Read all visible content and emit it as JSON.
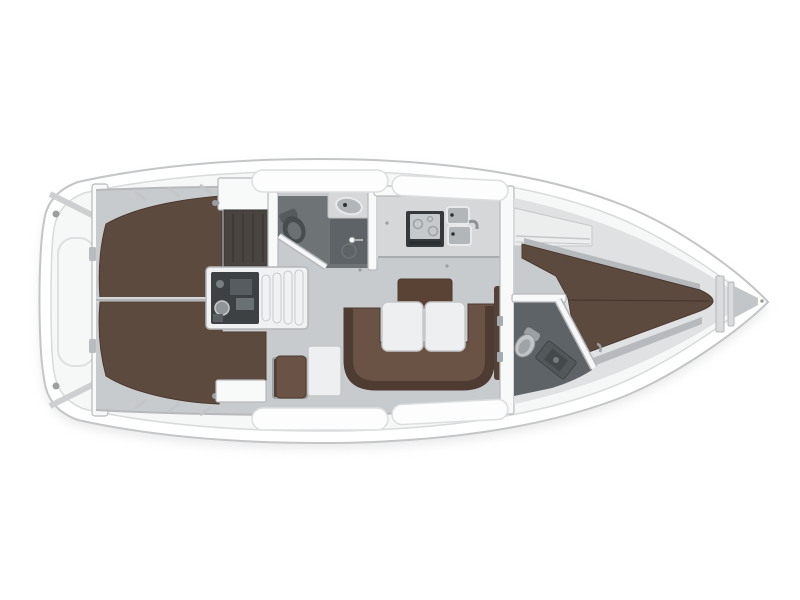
{
  "scene": {
    "type": "sailing-yacht-interior-floor-plan",
    "view": "top-down",
    "orientation": "bow-right-stern-left",
    "background": "#ffffff"
  },
  "colors": {
    "background": "#ffffff",
    "hull_fill": "#ffffff",
    "hull_stroke": "#c3c5c7",
    "deck_fill": "#f6f7f7",
    "deck_stroke": "#d8dadb",
    "wall_fill": "#f8f9f9",
    "wall_stroke": "#b6b8ba",
    "floor_fill": "#c8cbcd",
    "galley_counter": "#d5d7d9",
    "berth_brown": "#5c4a3e",
    "berth_brown_dark": "#54423a",
    "berth_edge": "#4a392f",
    "settee_seat": "#6a5244",
    "settee_back": "#4e3b31",
    "table_fill": "#edeff0",
    "table_stroke": "#c6c8ca",
    "shower_floor": "#5d6366",
    "head_floor": "#6e7376",
    "dark_locker": "#4a4440",
    "stove_body": "#35393c",
    "stove_panel": "#c6c9cb",
    "sink_fill": "#b2b6b8",
    "engine_body": "#3d4144",
    "engine_detail": "#8f9598",
    "steps_fill": "#f1f2f3",
    "fitting_gray": "#9b9fa2",
    "seam_line": "#46372e",
    "shelf_gray": "#b7babc",
    "shadow": "#d9dadb"
  },
  "features": {
    "hull": "hull-outline",
    "stern": "transom-and-lazarette",
    "aft_cabin_port": "aft-double-berth-port",
    "aft_cabin_stbd": "aft-double-berth-starboard",
    "companionway": "companionway-steps-and-engine",
    "aft_head": "aft-head-with-toilet-sink-shower",
    "galley": "galley-with-stove-and-double-sink",
    "salon": "salon-with-u-settee-and-folding-table",
    "nav_station": "nav-seat-and-chart-table",
    "fwd_head": "forward-head-with-toilet-and-vanity",
    "fwd_cabin": "forward-v-berth-cabin",
    "bow": "anchor-locker"
  }
}
